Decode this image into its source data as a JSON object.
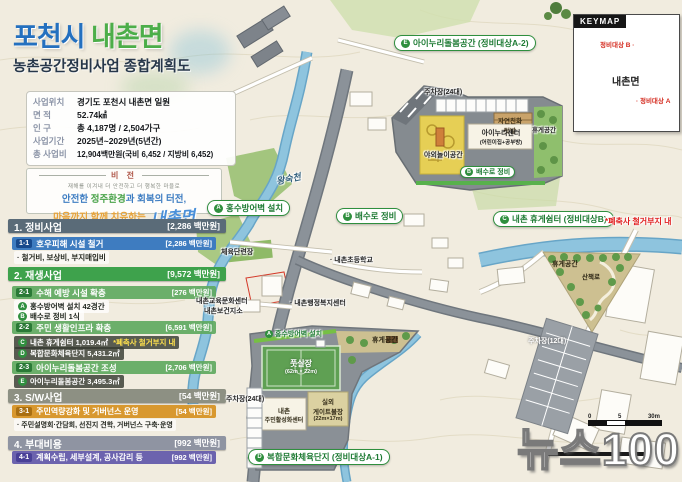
{
  "header": {
    "title_city": "포천시",
    "title_town": "내촌면",
    "subtitle": "농촌공간정비사업 종합계획도"
  },
  "info": {
    "rows": [
      {
        "label": "사업위치",
        "value": "경기도 포천시 내촌면 일원"
      },
      {
        "label": "면    적",
        "value": "52.74㎢"
      },
      {
        "label": "인    구",
        "value": "총 4,187명 / 2,504가구"
      },
      {
        "label": "사업기간",
        "value": "2025년~2029년(5년간)"
      },
      {
        "label": "총 사업비",
        "value": "12,904백만원(국비 6,452 / 지방비 6,452)"
      }
    ]
  },
  "vision": {
    "heading": "비 전",
    "tagline": "재해를 이겨내 더 안전하고 더 행복한 마을로",
    "l1a": "안전한 ",
    "l1b": "정주환경",
    "l1c": "과 회복의 터전,",
    "l2": "마음까지 함께 치유하는",
    "logo": "내촌면"
  },
  "list": {
    "s1": {
      "title": "1. 정비사업",
      "amount": "[2,286 백만원]"
    },
    "s1r1": {
      "badge": "1-1",
      "label": "호우피해 시설 철거",
      "amount": "[2,286 백만원]"
    },
    "s1note": "· 철거비, 보상비, 부지매입비",
    "s2": {
      "title": "2. 재생사업",
      "amount": "[9,572 백만원]"
    },
    "s2r1": {
      "badge": "2-1",
      "label": "수해 예방 시설 확충",
      "amount": "[276 백만원]"
    },
    "s2r1a": {
      "letter": "A",
      "text": "홍수방어벽 설치 42경간"
    },
    "s2r1b": {
      "letter": "B",
      "text": "배수로 정비 1식"
    },
    "s2r2": {
      "badge": "2-2",
      "label": "주민 생활인프라 확충",
      "amount": "[6,591 백만원]"
    },
    "s2r2c": {
      "letter": "C",
      "text": "내촌 휴게쉼터 1,019.4㎡",
      "note": "*폐축사 철거부지 내"
    },
    "s2r2d": {
      "letter": "D",
      "text": "복합문화체육단지 5,431.2㎡"
    },
    "s2r3": {
      "badge": "2-3",
      "label": "아이누리돌봄공간 조성",
      "amount": "[2,706 백만원]"
    },
    "s2r3e": {
      "letter": "E",
      "text": "아이누리돌봄공간 3,495.3㎡"
    },
    "s3": {
      "title": "3. S/W사업",
      "amount": "[54 백만원]"
    },
    "s3r1": {
      "badge": "3-1",
      "label": "주민역량강화 및 거버넌스 운영",
      "amount": "[54 백만원]"
    },
    "s3note": "· 주민설명회·간담회, 선진지 견학, 거버넌스 구축·운영",
    "s4": {
      "title": "4. 부대비용",
      "amount": "[992 백만원]"
    },
    "s4r1": {
      "badge": "4-1",
      "label": "계획수립, 세부설계, 공사감리 등",
      "amount": "[992 백만원]"
    }
  },
  "map": {
    "river": "왕숙천",
    "label_a": {
      "letter": "A",
      "text": "홍수방어벽 설치"
    },
    "label_b": {
      "letter": "B",
      "text": "배수로 정비"
    },
    "poi": {
      "sports": "체육단련장",
      "school": "· 내촌초등학교",
      "edu_center": "내촌교육문화센터",
      "health": "내촌보건지소",
      "admin": "· 내촌행정복지센터"
    },
    "inset_e": {
      "letter": "E",
      "title": "아이누리돌봄공간 (정비대상A-2)",
      "parking": "주차장(24대)",
      "garden1": "자연친화",
      "garden2": "텃밭",
      "center1": "아이누리센터",
      "center2": "(어린이집+공부방)",
      "rest": "휴게공간",
      "play": "야외놀이공간",
      "drain_letter": "B",
      "drain": "배수로 정비"
    },
    "inset_c": {
      "letter": "C",
      "title": "내촌 휴게쉼터 (정비대상B)",
      "note": "*폐축사 철거부지 내",
      "rest": "휴게공간",
      "trail": "산책로",
      "parking": "주차장(12대)"
    },
    "inset_d": {
      "letter": "D",
      "title": "복합문화체육단지 (정비대상A-1)",
      "wall_letter": "A",
      "wall": "홍수방어벽 설치",
      "futsal1": "풋살장",
      "futsal2": "(62m × 22m)",
      "rest": "휴게공간",
      "parking": "주차장(24대)",
      "center1": "내촌",
      "center2": "주민활성화센터",
      "gate1": "실외",
      "gate2": "게이트볼장",
      "gate3": "(22m×17m)"
    },
    "keymap": {
      "title": "KEYMAP",
      "region": "내촌면",
      "site_a": "· 정비대상 A",
      "site_b": "정비대상 B ·"
    },
    "scale": {
      "zero": "0",
      "five": "5",
      "end": "30m"
    },
    "watermark": "뉴스100"
  }
}
